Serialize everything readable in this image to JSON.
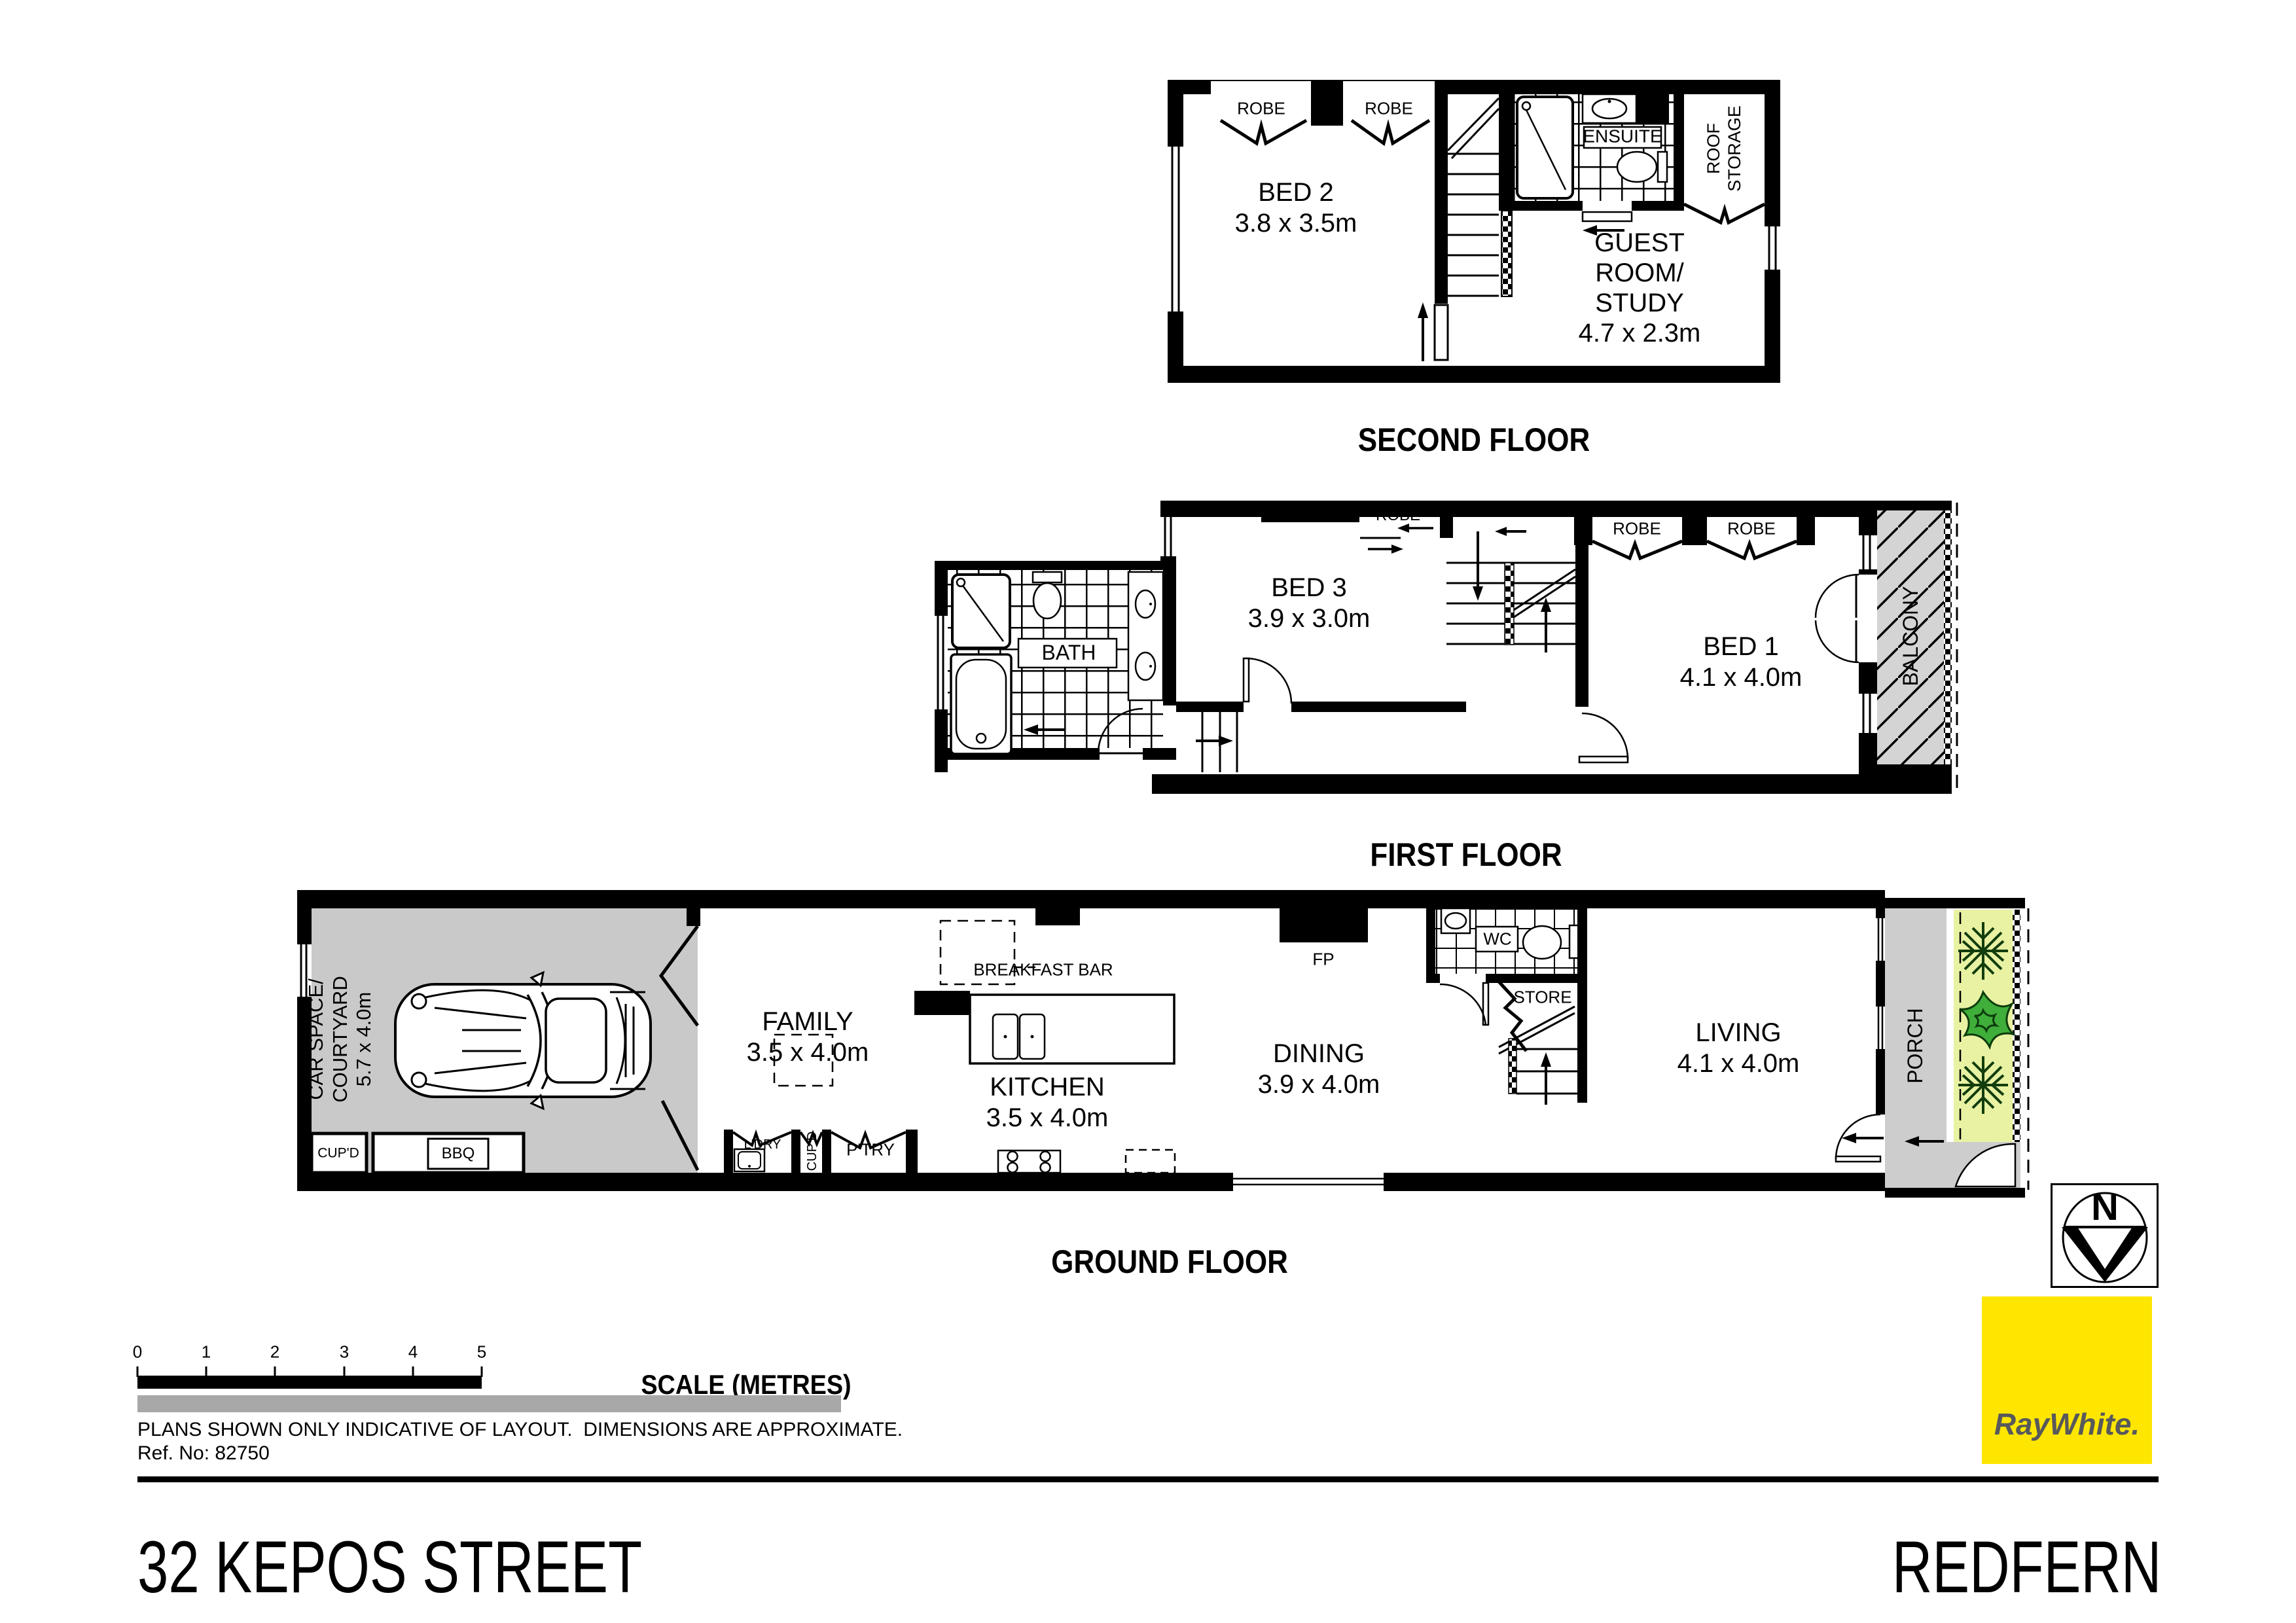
{
  "floors": {
    "second": {
      "title": "SECOND FLOOR",
      "rooms": {
        "bed2": "BED 2\n3.8 x 3.5m",
        "guest": "GUEST\nROOM/\nSTUDY\n4.7 x 2.3m",
        "ensuite": "ENSUITE",
        "roof_storage": "ROOF\nSTORAGE",
        "robe_left": "ROBE",
        "robe_right": "ROBE"
      }
    },
    "first": {
      "title": "FIRST FLOOR",
      "rooms": {
        "bed3": "BED 3\n3.9 x 3.0m",
        "bed1": "BED 1\n4.1 x 4.0m",
        "bath": "BATH",
        "balcony": "BALCONY",
        "robe_bed3": "ROBE",
        "robe_bed1_left": "ROBE",
        "robe_bed1_right": "ROBE"
      }
    },
    "ground": {
      "title": "GROUND FLOOR",
      "rooms": {
        "car_space": "CAR SPACE/\nCOURTYARD\n5.7 x 4.0m",
        "cupboard_left": "CUP'D",
        "bbq": "BBQ",
        "family": "FAMILY\n3.5 x 4.0m",
        "laundry": "L'DRY",
        "cupboard_mid": "CUP'D",
        "pantry": "P'TRY",
        "breakfast_bar": "BREAKFAST BAR",
        "kitchen": "KITCHEN\n3.5 x 4.0m",
        "fireplace": "FP",
        "dining": "DINING\n3.9 x 4.0m",
        "wc": "WC",
        "store": "STORE",
        "living": "LIVING\n4.1 x 4.0m",
        "porch": "PORCH"
      }
    }
  },
  "scale_bar": {
    "label": "SCALE (METRES)",
    "ticks": [
      "0",
      "1",
      "2",
      "3",
      "4",
      "5"
    ]
  },
  "notes": {
    "line1": "PLANS SHOWN ONLY INDICATIVE OF LAYOUT.  DIMENSIONS ARE APPROXIMATE.",
    "line2": "Ref. No: 82750"
  },
  "compass": {
    "north": "N"
  },
  "branding": {
    "agency": "RayWhite.",
    "accent": "#FFE600",
    "text_color": "#58595B"
  },
  "footer": {
    "address": "32 KEPOS STREET",
    "suburb": "REDFERN"
  },
  "colors": {
    "wall": "#000000",
    "courtyard_gray": "#c9c9c9",
    "porch_gray": "#cdcdcd",
    "balcony_gray": "#d4d4d4",
    "garden_green": "#e8f2a2",
    "plant_dark": "#123d0d",
    "plant_bright": "#3fae3a",
    "scale_gray": "#a8a8a8"
  }
}
